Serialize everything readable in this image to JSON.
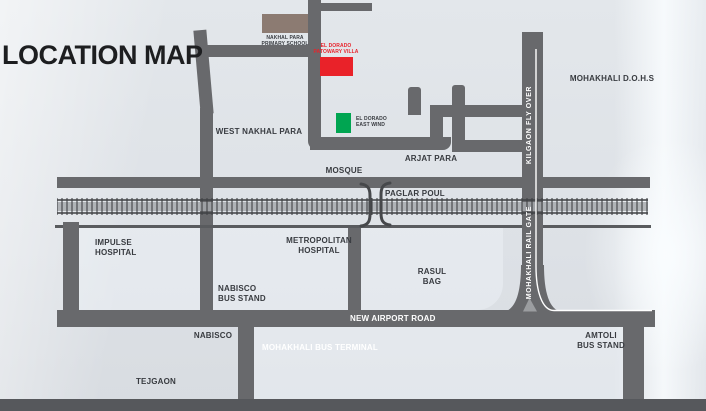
{
  "title": "LOCATION MAP",
  "colors": {
    "background": "#dfe3e8",
    "road": "#68696c",
    "road_dark": "#56585c",
    "rail": "#3e4043",
    "label_text": "#383b40",
    "road_label_text": "#ffffff",
    "school_box": "#8c7b72",
    "villa_box": "#e92229",
    "villa_label": "#e8232b",
    "eastwind_box": "#00a551",
    "rail_gate_arrow": "#9b9da0",
    "flyover_line": "#ffffff"
  },
  "landmarks": {
    "school": {
      "lines": [
        "NAKHAL PARA",
        "PRIMARY SCHOOL"
      ]
    },
    "villa": {
      "lines": [
        "EL DORADO",
        "PATOWARY VILLA"
      ]
    },
    "eastwind": {
      "lines": [
        "EL DORADO",
        "EAST WIND"
      ]
    }
  },
  "areas": {
    "west_nakhal_para": "WEST NAKHAL PARA",
    "mosque": "MOSQUE",
    "arjat_para": "ARJAT PARA",
    "paglar_poul": "PAGLAR POUL",
    "mohakhali_dohs": "MOHAKHALI D.O.H.S",
    "impulse_hospital": {
      "lines": [
        "IMPULSE",
        "HOSPITAL"
      ]
    },
    "metropolitan_hospital": {
      "lines": [
        "METROPOLITAN",
        "HOSPITAL"
      ]
    },
    "nabisco_bus_stand": {
      "lines": [
        "NABISCO",
        "BUS STAND"
      ]
    },
    "rasul_bag": {
      "lines": [
        "RASUL",
        "BAG"
      ]
    },
    "nabisco": "NABISCO",
    "tejgaon": "TEJGAON",
    "amtoli_bus_stand": {
      "lines": [
        "AMTOLI",
        "BUS STAND"
      ]
    }
  },
  "roads": {
    "new_airport_road": "NEW AIRPORT ROAD",
    "mohakhali_bus_terminal": "MOHAKHALI BUS TERMINAL",
    "kilgaon_fly_over": "KILGAON FLY OVER",
    "mohakhali_rail_gate": "MOHAKHALI RAIL GATE"
  }
}
